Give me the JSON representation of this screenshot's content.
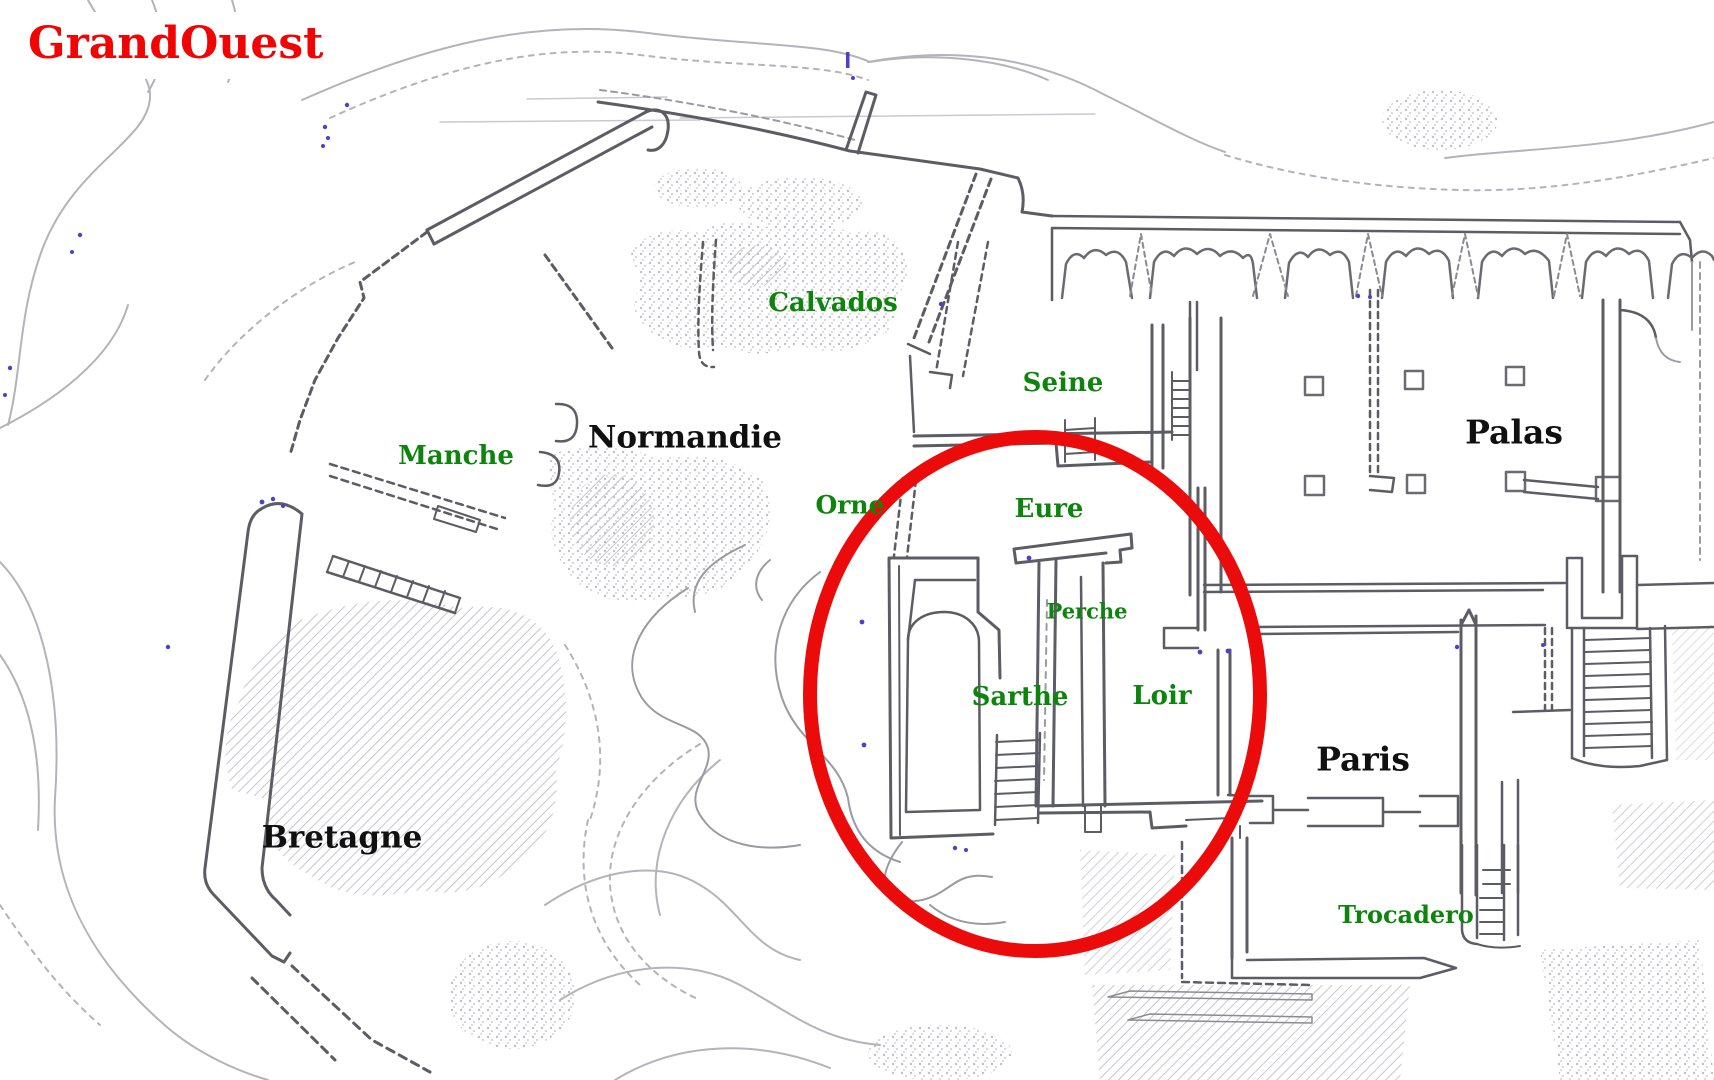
{
  "title": {
    "text": "GrandOuest"
  },
  "colors": {
    "title_red": "#f10404",
    "label_green": "#0d850d",
    "label_black": "#101010",
    "highlight_red": "#ec0b0b",
    "sketch_dark": "#5c5c65",
    "sketch_light": "#b3b3bb",
    "speck_blue": "#4a41cc",
    "background": "#ffffff"
  },
  "labels": [
    {
      "id": "calvados",
      "text": "Calvados",
      "kind": "district"
    },
    {
      "id": "seine",
      "text": "Seine",
      "kind": "district"
    },
    {
      "id": "manche",
      "text": "Manche",
      "kind": "district"
    },
    {
      "id": "normandie",
      "text": "Normandie",
      "kind": "region"
    },
    {
      "id": "orne",
      "text": "Orne",
      "kind": "district"
    },
    {
      "id": "eure",
      "text": "Eure",
      "kind": "district"
    },
    {
      "id": "perche",
      "text": "Perche",
      "kind": "district"
    },
    {
      "id": "sarthe",
      "text": "Sarthe",
      "kind": "district"
    },
    {
      "id": "loir",
      "text": "Loir",
      "kind": "district"
    },
    {
      "id": "palas",
      "text": "Palas",
      "kind": "region"
    },
    {
      "id": "paris",
      "text": "Paris",
      "kind": "region"
    },
    {
      "id": "trocadero",
      "text": "Trocadero",
      "kind": "district"
    },
    {
      "id": "bretagne",
      "text": "Bretagne",
      "kind": "region"
    }
  ],
  "highlight": {
    "shape": "ellipse",
    "color": "#ec0b0b",
    "cx": 1035,
    "cy": 694,
    "rx": 225,
    "ry": 257,
    "stroke_width": 14
  }
}
